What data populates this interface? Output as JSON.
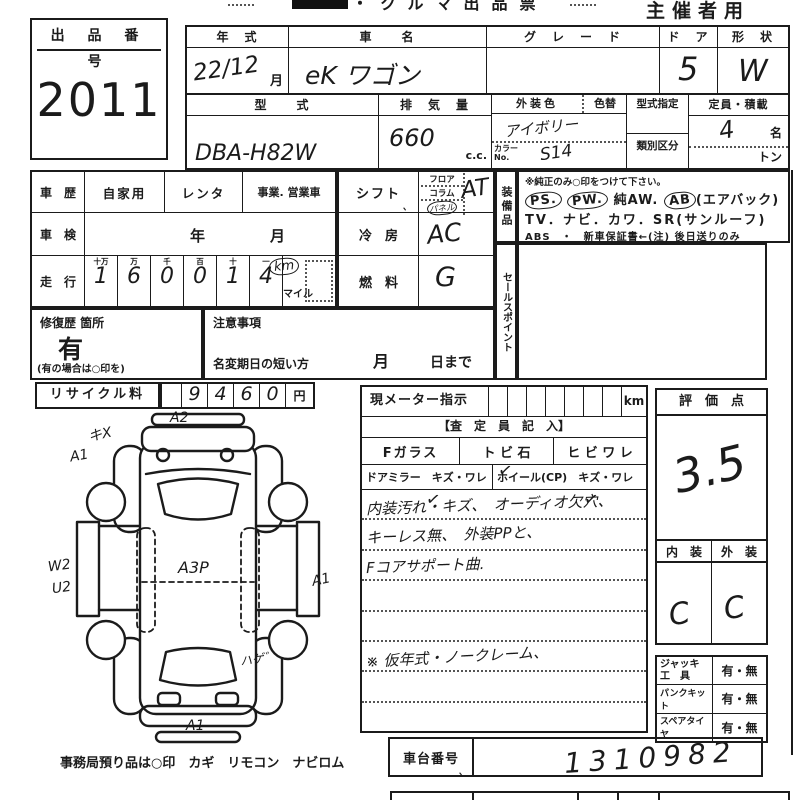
{
  "paper": {
    "ink": "#1b1b1b",
    "bg": "#ffffff"
  },
  "header": {
    "title_fragment": "・クルマ出品票",
    "organizer": "主催者用"
  },
  "lot": {
    "label": "出 品 番 号",
    "number": "2011"
  },
  "top_table": {
    "year": {
      "label": "年　式",
      "value": "22/12",
      "unit": "月"
    },
    "name": {
      "label": "車　　名",
      "value": "eK ワゴン"
    },
    "grade": {
      "label": "グ　レ　ー　ド",
      "value": ""
    },
    "doors": {
      "label": "ド　ア",
      "value": "5"
    },
    "shape": {
      "label": "形　状",
      "value": "W"
    },
    "model": {
      "label": "型　　式",
      "value": "DBA-H82W"
    },
    "displacement": {
      "label": "排　気　量",
      "value": "660",
      "unit": "c.c."
    },
    "ext_color": {
      "label": "外装色",
      "value": "アイボリー",
      "change_label": "色替",
      "color_no_label": "カラーNo.",
      "color_no": "S14"
    },
    "designation": {
      "label": "型式指定",
      "class_label": "類別区分"
    },
    "capacity": {
      "label": "定員・積載",
      "value": "4",
      "unit": "名",
      "ton": "トン"
    }
  },
  "history": {
    "label": "車　歴",
    "opt1": "自家用",
    "opt2": "レンタ",
    "opt3": "事業. 営業車"
  },
  "inspection": {
    "label": "車　検",
    "year": "年",
    "month": "月"
  },
  "mileage": {
    "label": "走　行",
    "headers": [
      "十万",
      "万",
      "千",
      "百",
      "十",
      "一"
    ],
    "digits": [
      "1",
      "6",
      "0",
      "0",
      "1",
      "4"
    ],
    "km": "km",
    "mile": "マイル"
  },
  "shift": {
    "label": "シフト",
    "tick": "、",
    "opt1": "フロア",
    "opt2": "コラム",
    "opt3": "パネル",
    "value": "AT"
  },
  "cooling": {
    "label": "冷　房",
    "value": "AC"
  },
  "fuel": {
    "label": "燃　料",
    "value": "G"
  },
  "equipment": {
    "label": "装備品",
    "note": "※純正のみ○印をつけて下さい。",
    "ps": "PS.",
    "pw": "PW.",
    "aw": "純AW.",
    "ab": "AB",
    "ab_suffix": "(エアバック)",
    "line2": "TV．ナビ．カワ．SR(サンルーフ)",
    "line3": "ABS　・　新車保証書←(注) 後日送りのみ"
  },
  "sales_point": {
    "label": "セールスポイント"
  },
  "repair": {
    "label": "修復歴 箇所",
    "value": "有",
    "note": "(有の場合は○印を)"
  },
  "caution": {
    "label": "注意事項",
    "deadline": "名変期日の短い方",
    "month": "月",
    "day": "日まで"
  },
  "recycle": {
    "label": "リサイクル料",
    "digits": [
      "9",
      "4",
      "6",
      "0"
    ],
    "yen": "円"
  },
  "diagram": {
    "a2": "A2",
    "scratch": "キX",
    "a1_front": "A1",
    "w2": "W2",
    "u2": "U2",
    "a3p": "A3P",
    "a1_side": "A1",
    "hage": "ハゲ゛",
    "a1_rear": "A1",
    "footer": "事務局預り品は○印　カギ　リモコン　ナビロム"
  },
  "meter": {
    "label": "現メーター指示",
    "unit": "km"
  },
  "assessor": {
    "header": "【査　定　員　記　入】",
    "fglass": "Fガラス",
    "tobiishi": "ト ビ 石",
    "hibiware": "ヒ ビ ワ レ",
    "mirror": "ドアミラー　キズ・ワレ",
    "wheel": "ホイール(CP)　キズ・ワレ",
    "check": "✓",
    "note1": "内装汚れ・キズ、　オーディオ欠穴、",
    "note2": "キーレス無、　外装PPと、",
    "note3": "Fコアサポート曲.",
    "note6": "※ 仮年式・ノークレーム、"
  },
  "chassis": {
    "label": "車台番号",
    "tick": "、",
    "value": "1310982"
  },
  "score": {
    "label": "評　価　点",
    "value": "3.5",
    "interior_label": "内　装",
    "exterior_label": "外　装",
    "interior": "C",
    "exterior": "C"
  },
  "tools": {
    "jack_label": "ジャッキ",
    "jack_label2": "工　具",
    "jack_value": "有・無",
    "kit_label": "パンクキット",
    "kit_value": "有・無",
    "spare_label": "スペアタイヤ",
    "spare_value": "有・無"
  }
}
